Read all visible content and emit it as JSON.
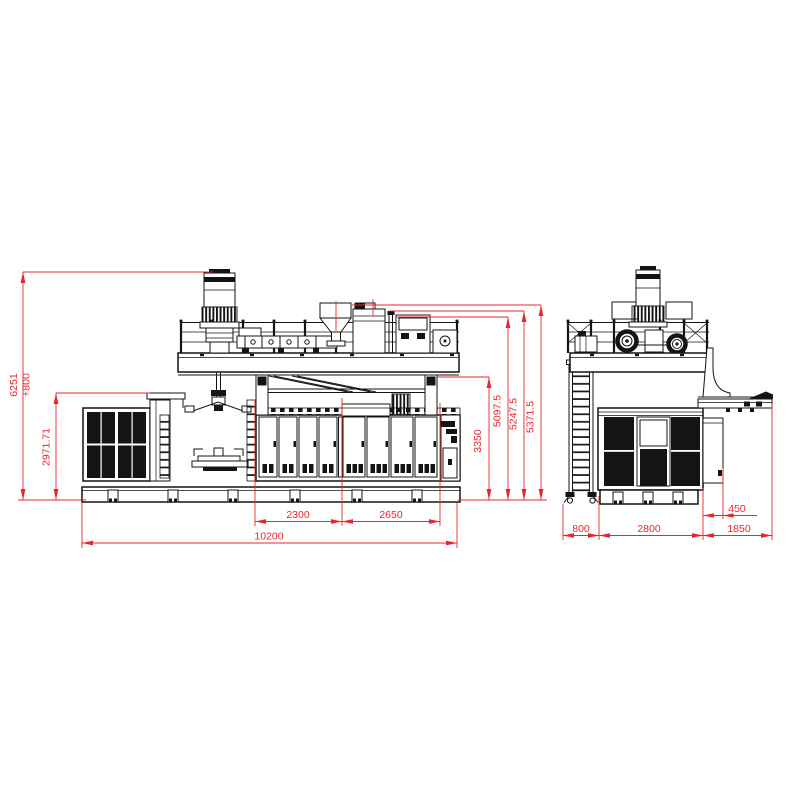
{
  "colors": {
    "background": "#ffffff",
    "ink": "#141414",
    "dimension": "#e8262b"
  },
  "dims": {
    "front": {
      "height_total_a": "6251",
      "height_total_b": "+800",
      "height_cabinet": "2971.71",
      "height_frame": "3350",
      "height_level_1": "5097.5",
      "height_level_2": "5247.5",
      "height_level_3": "5371.5",
      "pitch_left": "2300",
      "pitch_right": "2650",
      "length_total": "10200"
    },
    "side": {
      "width_ladder": "800",
      "width_body": "2800",
      "width_conveyor": "1850",
      "width_side_cabinet": "450"
    }
  }
}
